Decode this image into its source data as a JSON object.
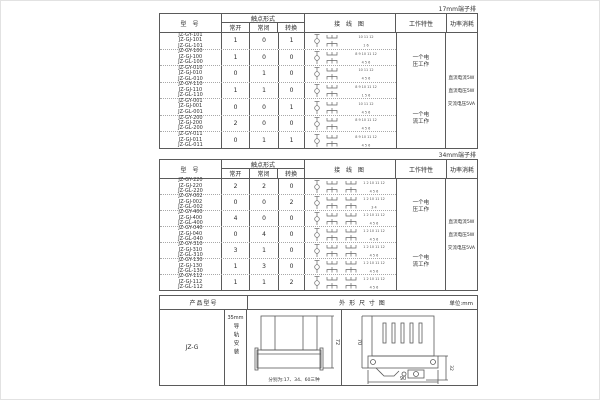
{
  "colors": {
    "ink": "#2b2b2b",
    "line": "#5a5a5a"
  },
  "sections": {
    "table1_label": "17mm端子排",
    "table2_label": "34mm端子排"
  },
  "spec_header": {
    "model": "型 号",
    "contact_form": "触点形式",
    "normally_open": "常开",
    "normally_closed": "常闭",
    "changeover": "转换",
    "wiring_diagram": "接 线 图",
    "work_characteristic": "工作特性",
    "power_consumption": "功率消耗"
  },
  "work_characteristics": [
    "一个电压工作",
    "一个电流工作"
  ],
  "power_consumption_lines": [
    "直流电流5W",
    "直流电压5W",
    "交流电压5VA"
  ],
  "table1": {
    "rows": [
      {
        "models": [
          "JZ-GY-101",
          "JZ-GJ-101",
          "JZ-GL-101"
        ],
        "no": "1",
        "nc": "0",
        "co": "1",
        "wiring_top": "10 11 12",
        "wiring_bottom": "1 6"
      },
      {
        "models": [
          "JZ-GY-100",
          "JZ-GJ-100",
          "JZ-GL-100"
        ],
        "no": "1",
        "nc": "0",
        "co": "0",
        "wiring_top": "8 9 10 11 12",
        "wiring_bottom": "4 5 6"
      },
      {
        "models": [
          "JZ-GY-010",
          "JZ-GJ-010",
          "JZ-GL-010"
        ],
        "no": "0",
        "nc": "1",
        "co": "0",
        "wiring_top": "10 11 12",
        "wiring_bottom": "4 5 6"
      },
      {
        "models": [
          "JZ-GY-110",
          "JZ-GJ-110",
          "JZ-GL-110"
        ],
        "no": "1",
        "nc": "1",
        "co": "0",
        "wiring_top": "8 9 10 11 12",
        "wiring_bottom": "1 5 6"
      },
      {
        "models": [
          "JZ-GY-001",
          "JZ-GJ-001",
          "JZ-GL-001"
        ],
        "no": "0",
        "nc": "0",
        "co": "1",
        "wiring_top": "10 11 12",
        "wiring_bottom": "4 5 6"
      },
      {
        "models": [
          "JZ-GY-200",
          "JZ-GJ-200",
          "JZ-GL-200"
        ],
        "no": "2",
        "nc": "0",
        "co": "0",
        "wiring_top": "8 9 10 11 12",
        "wiring_bottom": "4 5 6"
      },
      {
        "models": [
          "JZ-GY-011",
          "JZ-GJ-011",
          "JZ-GL-011"
        ],
        "no": "0",
        "nc": "1",
        "co": "1",
        "wiring_top": "8 9 10 11 12",
        "wiring_bottom": "4 5 6"
      }
    ]
  },
  "table2": {
    "rows": [
      {
        "models": [
          "JZ-GY-220",
          "JZ-GJ-220",
          "JZ-GL-220"
        ],
        "no": "2",
        "nc": "2",
        "co": "0",
        "wiring_top": "1 2 10 11 12",
        "wiring_bottom": "4 5 6"
      },
      {
        "models": [
          "JZ-GY-002",
          "JZ-GJ-002",
          "JZ-GL-002"
        ],
        "no": "0",
        "nc": "0",
        "co": "2",
        "wiring_top": "1 2 10 11 12",
        "wiring_bottom": "3 4"
      },
      {
        "models": [
          "JZ-GY-400",
          "JZ-GJ-400",
          "JZ-GL-400"
        ],
        "no": "4",
        "nc": "0",
        "co": "0",
        "wiring_top": "1 2 10 11 12",
        "wiring_bottom": "4 5 6"
      },
      {
        "models": [
          "JZ-GY-040",
          "JZ-GJ-040",
          "JZ-GL-040"
        ],
        "no": "0",
        "nc": "4",
        "co": "0",
        "wiring_top": "1 2 10 11 12",
        "wiring_bottom": "4 5 6"
      },
      {
        "models": [
          "JZ-GY-310",
          "JZ-GJ-310",
          "JZ-GL-310"
        ],
        "no": "3",
        "nc": "1",
        "co": "0",
        "wiring_top": "1 2 10 11 12",
        "wiring_bottom": "4 5 6"
      },
      {
        "models": [
          "JZ-GY-130",
          "JZ-GJ-130",
          "JZ-GL-130"
        ],
        "no": "1",
        "nc": "3",
        "co": "0",
        "wiring_top": "1 2 10 11 12",
        "wiring_bottom": "4 5 6"
      },
      {
        "models": [
          "JZ-GY-112",
          "JZ-GJ-112",
          "JZ-GL-112"
        ],
        "no": "1",
        "nc": "1",
        "co": "2",
        "wiring_top": "1 2 10 11 12",
        "wiring_bottom": "4 5 6"
      }
    ]
  },
  "outline": {
    "product_model_header": "产品型号",
    "dimension_header": "外 形 尺 寸 图",
    "unit_label": "单位:mm",
    "product_model": "JZ-G",
    "mount_size": "35mm",
    "mount_text": "导轨安装",
    "front_caption": "分别为:17、34、60三种",
    "dim_front_height": "72",
    "dim_side_height": "70",
    "dim_side_width": "90",
    "dim_side_depth": "32"
  }
}
